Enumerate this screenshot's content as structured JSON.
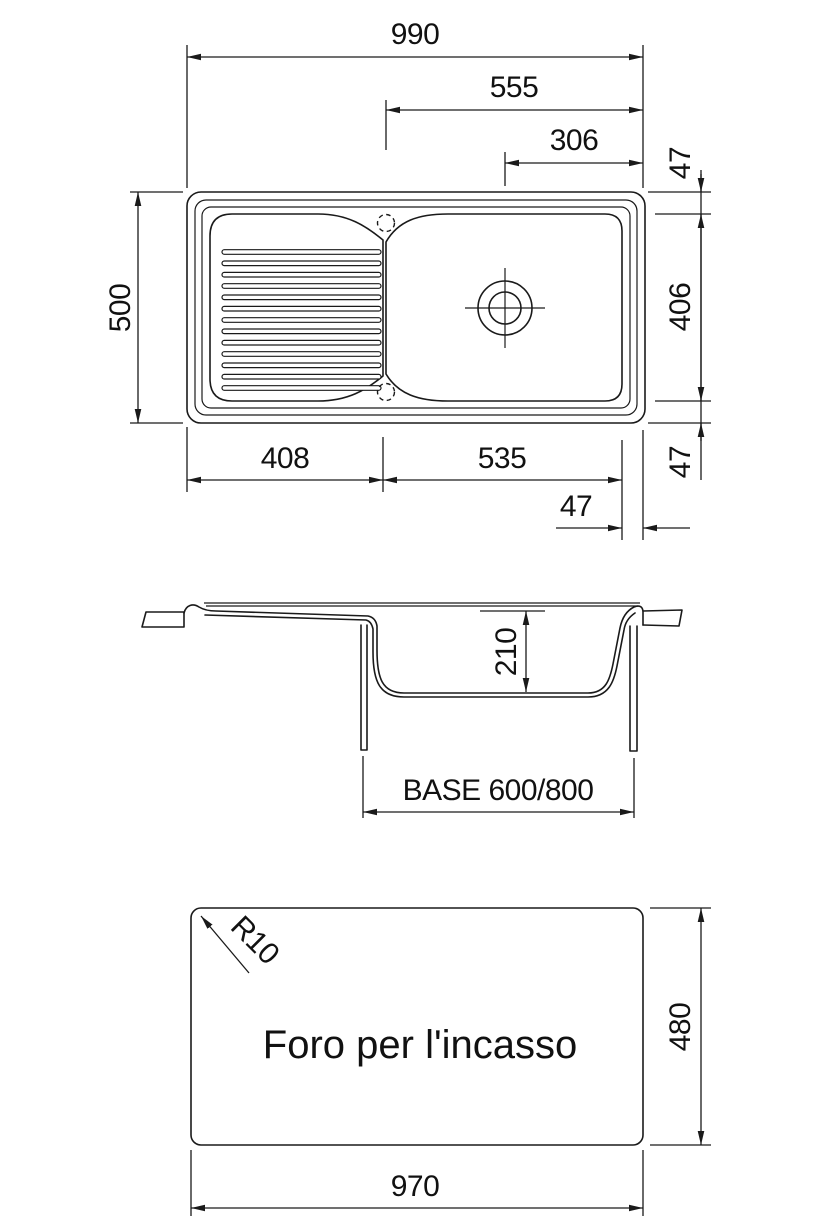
{
  "colors": {
    "background": "#ffffff",
    "line": "#1a1a1a",
    "text": "#111111"
  },
  "top_view": {
    "dims": {
      "overall_width": "990",
      "bowl_center_from_right": "555",
      "drain_from_right": "306",
      "rim_top_47": "47",
      "basin_height": "406",
      "rim_bottom_47": "47",
      "overall_depth": "500",
      "drainer_width": "408",
      "bowl_width": "535",
      "rim_right_47": "47"
    }
  },
  "section_view": {
    "dims": {
      "bowl_depth": "210"
    },
    "base_label": "BASE 600/800"
  },
  "cutout_view": {
    "label": "Foro per l'incasso",
    "dims": {
      "corner_radius": "R10",
      "width": "970",
      "height": "480"
    }
  }
}
